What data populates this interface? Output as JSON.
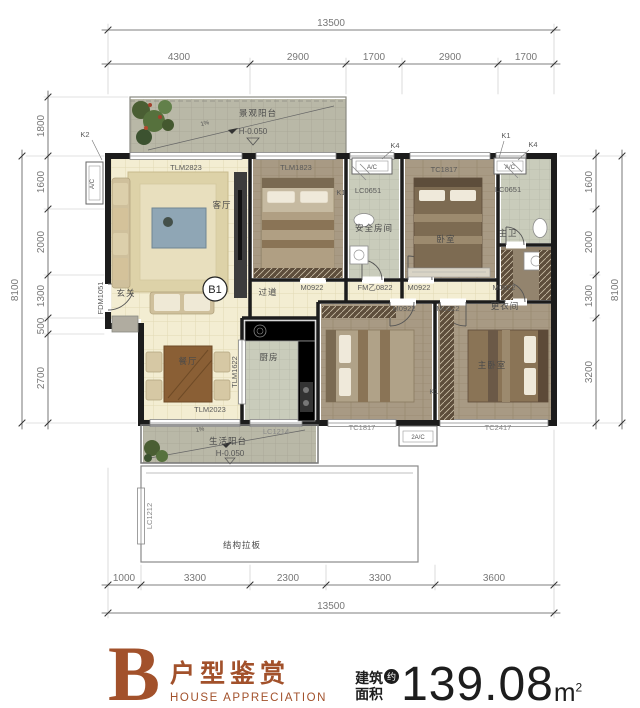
{
  "footer": {
    "letter": "B",
    "title_cn": "户型鉴赏",
    "title_en": "HOUSE APPRECIATION",
    "area_label_line1": "建筑",
    "area_label_line2": "面积",
    "approx_badge": "约",
    "area_value": "139.08",
    "area_unit": "m",
    "area_sup": "2",
    "brand_color": "#A2512B"
  },
  "dimensions": {
    "top": {
      "total": "13500",
      "segments": [
        "4300",
        "2900",
        "1700",
        "2900",
        "1700"
      ]
    },
    "bottom": {
      "total": "13500",
      "segments": [
        "1000",
        "3300",
        "2300",
        "3300",
        "3600"
      ]
    },
    "left": {
      "total": "8100",
      "segments": [
        "1800",
        "1600",
        "2000",
        "1300",
        "500",
        "2700"
      ]
    },
    "right": {
      "total": "8100",
      "segments": [
        "1600",
        "2000",
        "1300",
        "3200"
      ]
    }
  },
  "rooms": {
    "living": "客厅",
    "dining": "餐厅",
    "kitchen": "厨房",
    "corridor": "过道",
    "entry": "玄关",
    "bedroom2": "卧室",
    "master_bedroom": "主卧室",
    "master_bath": "主卫",
    "bath": "安全房间",
    "dressing": "更衣间",
    "balcony_top": "景观阳台",
    "balcony_bottom": "生活阳台",
    "structure_note": "结构拉板"
  },
  "levels": {
    "balcony_top_level": "H-0.050",
    "balcony_bottom_level": "H-0.050",
    "slope": "1%"
  },
  "openings": {
    "living_window": "TLM2823",
    "bedroom1_door": "TLM1823",
    "bedroom2_window": "TC1817",
    "bedroom3_window": "TC1817",
    "master_window": "TC2417",
    "bath_window_left": "LC0651",
    "bath_window_right": "LC0651",
    "dining_window": "TLM2023",
    "kitchen_slide": "TLM1622",
    "kitchen_window": "LC1214",
    "structure_window": "LC1212",
    "entry_door": "FDM1051",
    "swing_door": "M0922",
    "fire_door": "FM乙0822",
    "dressing_door": "M0822",
    "unit_mark": "B1"
  },
  "marks": {
    "k1": "K1",
    "k2": "K2",
    "k4": "K4",
    "ac": "A/C",
    "ac2": "2A/C"
  }
}
